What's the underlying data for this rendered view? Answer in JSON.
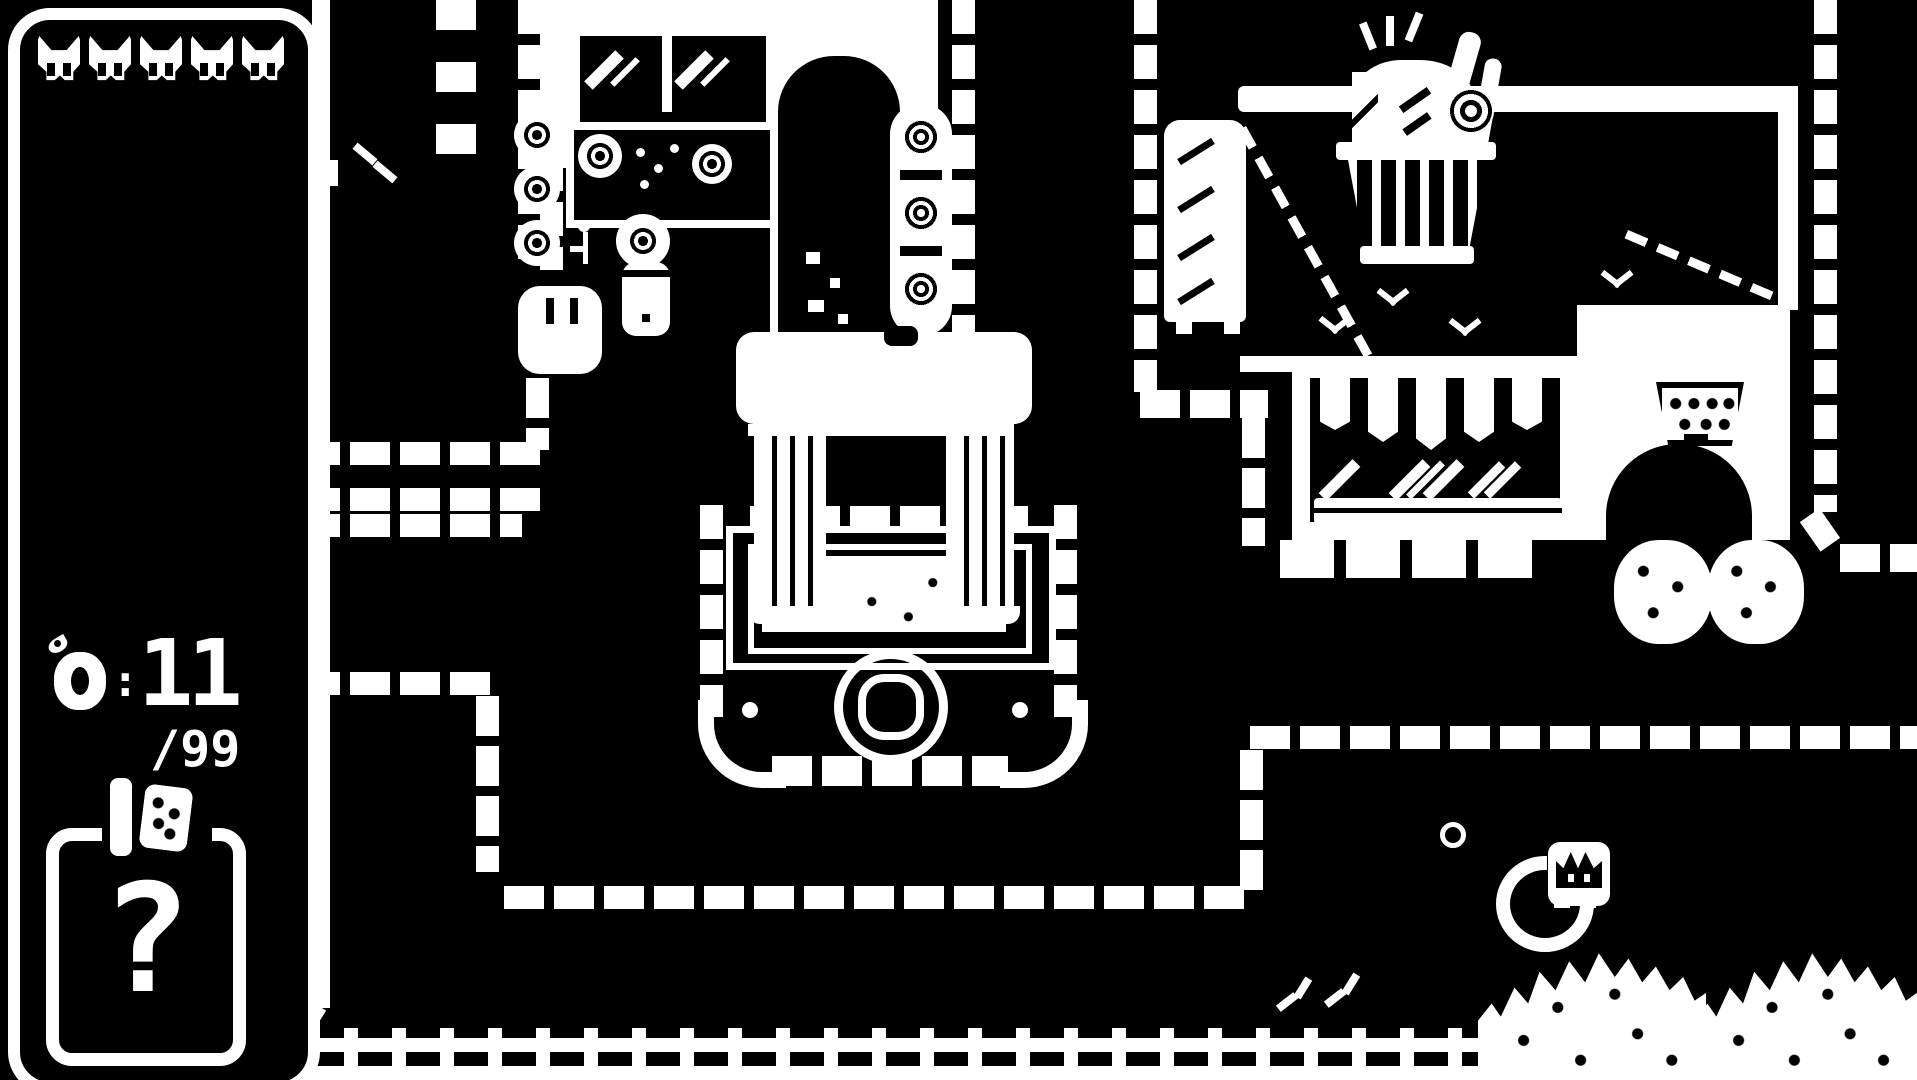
{
  "colors": {
    "background": "#000000",
    "ink": "#ffffff"
  },
  "hud": {
    "lives": {
      "icon": "cat-head-icon",
      "count": 5
    },
    "collectible_counter": {
      "icon": "apple-icon",
      "separator": ":",
      "value": "11",
      "total": "/99"
    },
    "item_slot": {
      "placeholder": "?",
      "topper_icon": "berry-pouch-icon"
    }
  },
  "scene": {
    "region": "town plaza",
    "objects": "flower-shop-interior, dark-doorway, stone-monument, wash-basin, market-shop, grocery-basket-sign, striped-awning, hanging-lamp, shop-doorway, topiary-bushes, tall-cabinet, brick-paths, wooden-fence, hedge-bushes, sleeping-cat, sparkles"
  }
}
